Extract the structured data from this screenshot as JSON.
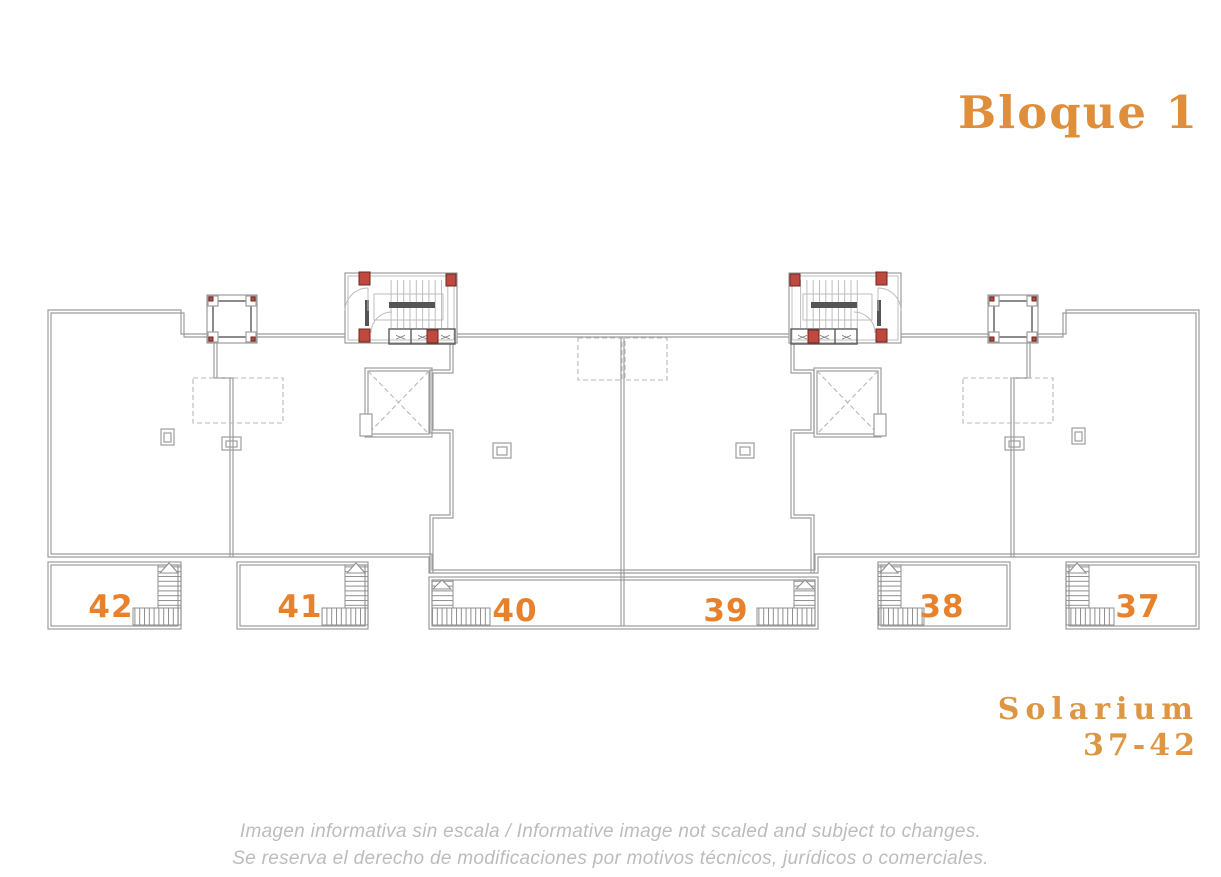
{
  "title": {
    "text": "Bloque 1"
  },
  "solarium_label": {
    "line1": "Solarium",
    "line2": "37-42"
  },
  "disclaimer": {
    "line1": "Imagen informativa sin escala /  Informative image not scaled and subject to changes.",
    "line2": "Se reserva el derecho de modificaciones por motivos técnicos, jurídicos o comerciales."
  },
  "plan": {
    "block_name": "Bloque 1",
    "units": [
      {
        "number": "42"
      },
      {
        "number": "41"
      },
      {
        "number": "40"
      },
      {
        "number": "39"
      },
      {
        "number": "38"
      },
      {
        "number": "37"
      }
    ],
    "machine_symbol": "><"
  },
  "colors": {
    "title": "#df8f3c",
    "solarium": "#dd9643",
    "unit_number": "#e8812c",
    "disclaimer": "#bcbcbc",
    "wall": "#9c9c9c",
    "wall_dark": "#4f4f4f",
    "column_red": "#c0493f",
    "dashed": "#b8b8b8",
    "hatch": "#8f8f8f"
  }
}
